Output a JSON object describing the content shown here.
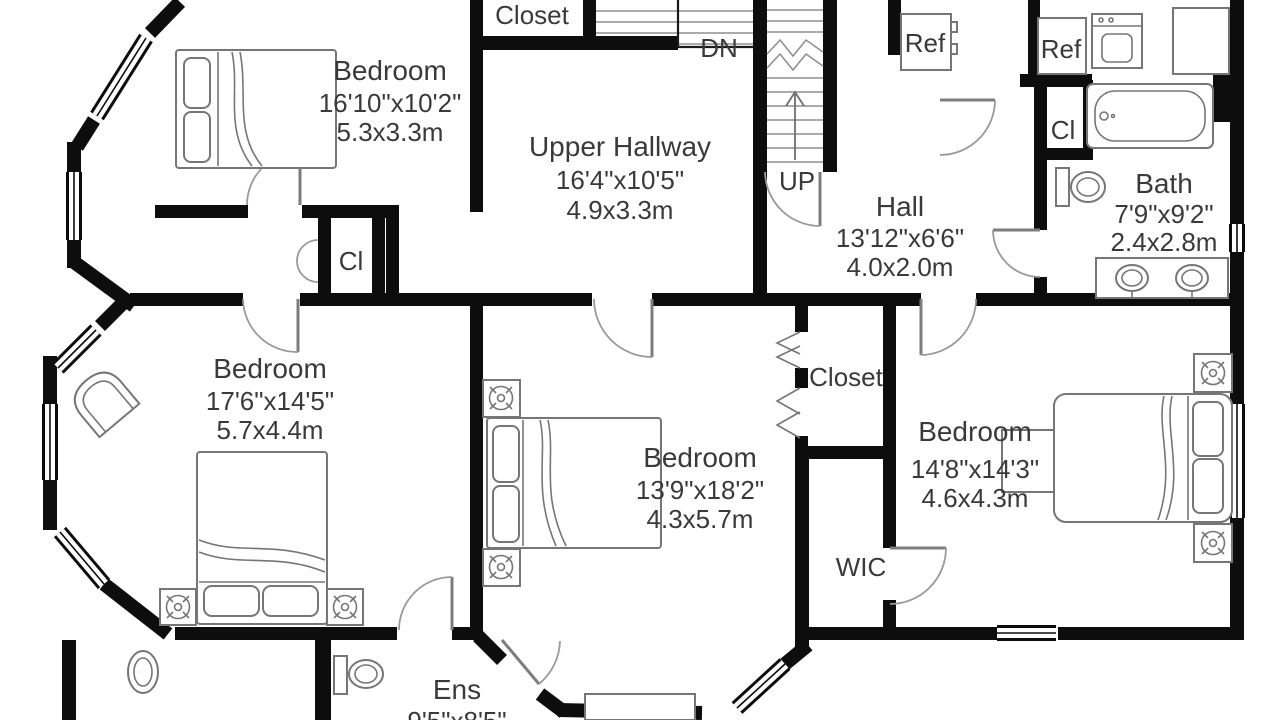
{
  "plan": {
    "rooms": [
      {
        "id": "bedroom-top-left",
        "name": "Bedroom",
        "imperial": "16'10\"x10'2\"",
        "metric": "5.3x3.3m"
      },
      {
        "id": "upper-hallway",
        "name": "Upper Hallway",
        "imperial": "16'4\"x10'5\"",
        "metric": "4.9x3.3m"
      },
      {
        "id": "hall",
        "name": "Hall",
        "imperial": "13'12\"x6'6\"",
        "metric": "4.0x2.0m"
      },
      {
        "id": "bath",
        "name": "Bath",
        "imperial": "7'9\"x9'2\"",
        "metric": "2.4x2.8m"
      },
      {
        "id": "bedroom-left",
        "name": "Bedroom",
        "imperial": "17'6\"x14'5\"",
        "metric": "5.7x4.4m"
      },
      {
        "id": "bedroom-middle",
        "name": "Bedroom",
        "imperial": "13'9\"x18'2\"",
        "metric": "4.3x5.7m"
      },
      {
        "id": "bedroom-right",
        "name": "Bedroom",
        "imperial": "14'8\"x14'3\"",
        "metric": "4.6x4.3m"
      },
      {
        "id": "ensuite",
        "name": "Ens",
        "imperial": "9'5\"x8'5\""
      }
    ],
    "labels": {
      "closet_top": "Closet",
      "closet_right": "Closet",
      "cl_left": "Cl",
      "cl_bath": "Cl",
      "wic": "WIC",
      "ref_hall": "Ref",
      "ref_laundry": "Ref",
      "stairs_down": "DN",
      "stairs_up": "UP"
    },
    "colors": {
      "wall": "#0d0d0d",
      "furniture_line": "#767676",
      "text": "#3a3a3a",
      "background": "#ffffff"
    }
  }
}
